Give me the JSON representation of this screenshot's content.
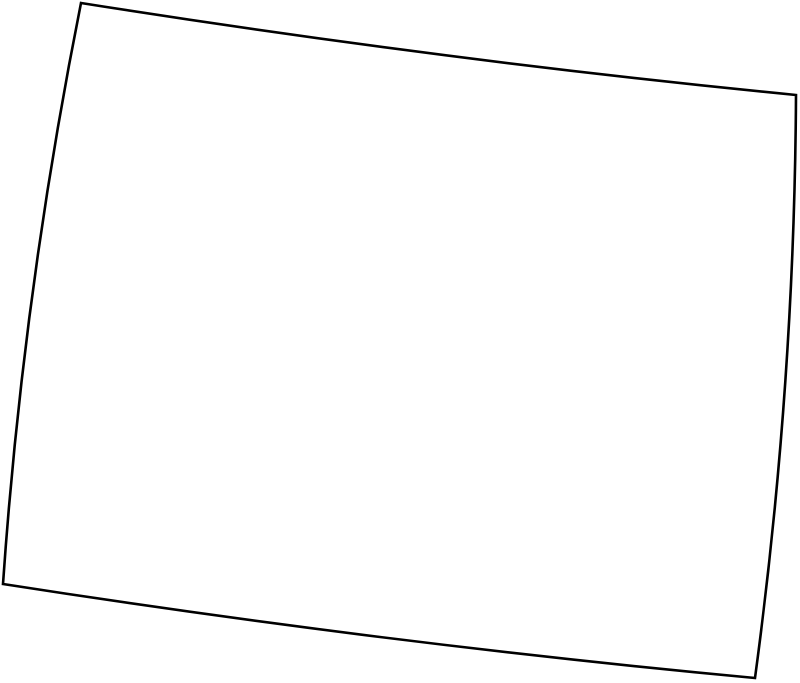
{
  "canvas": {
    "width": "800",
    "height": "683",
    "background_color": "#ffffff"
  },
  "state_outline": {
    "viewbox": "0 0 800 683",
    "stroke_color": "#000000",
    "fill_color": "#ffffff",
    "stroke_width": "2.6",
    "corners": {
      "top_left": [
        81,
        3
      ],
      "top_right": [
        796,
        95
      ],
      "bottom_right": [
        755,
        678
      ],
      "bottom_left": [
        3,
        584
      ]
    },
    "path": "M 81 3 Q 440 60 796 95 Q 794.5 385.5 755 678 Q 381 643 3 584 Q 23 293.5 81 3 Z"
  }
}
